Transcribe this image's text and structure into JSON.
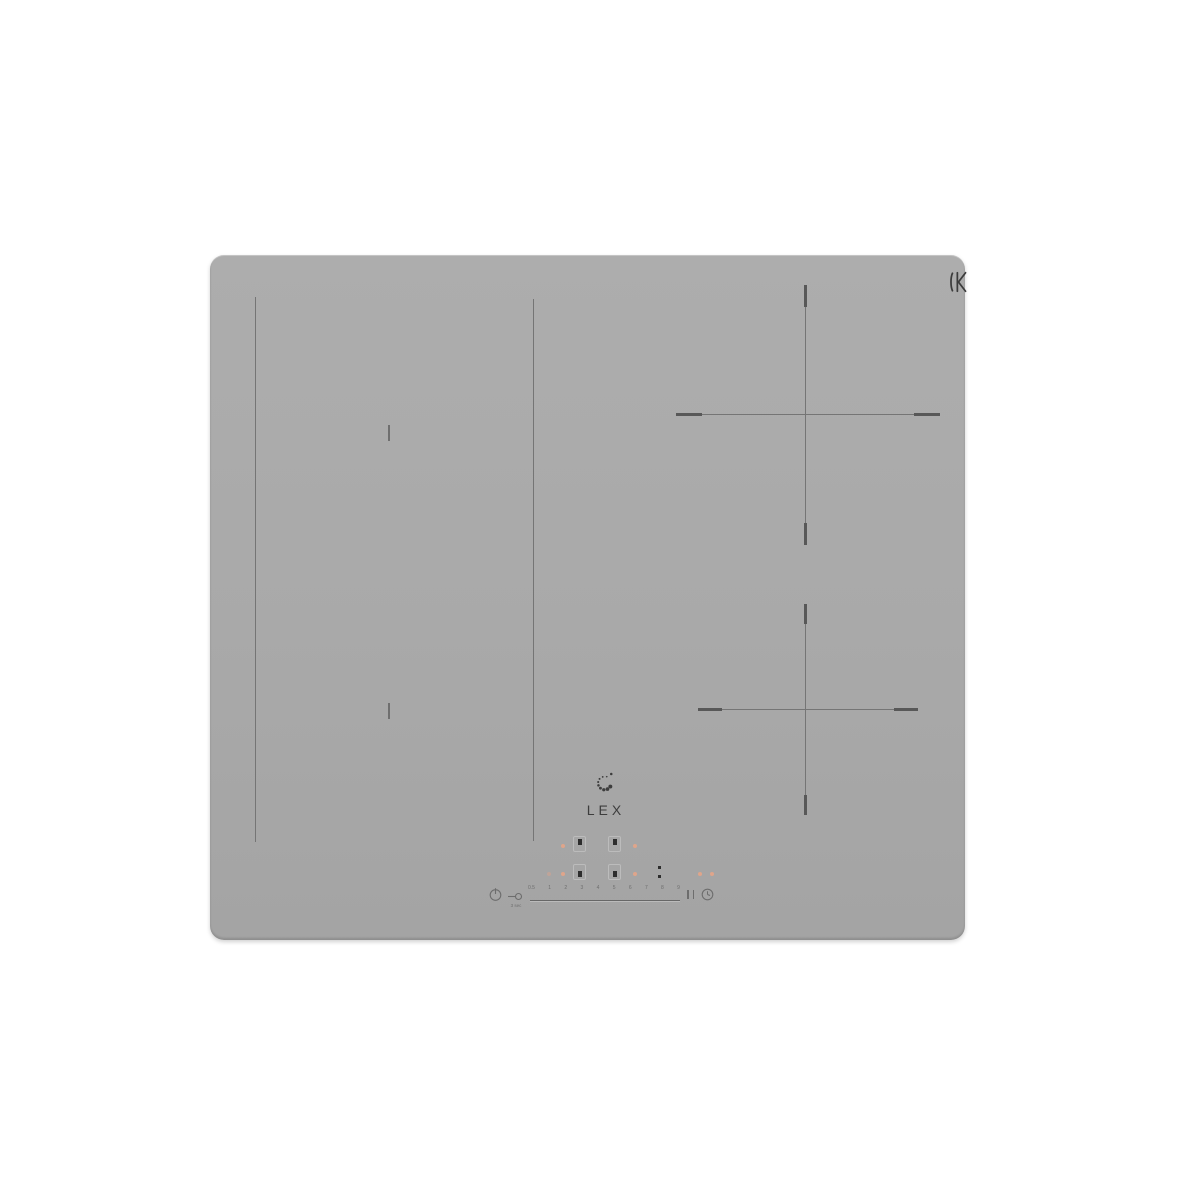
{
  "image_type": "product-photo",
  "product": {
    "brand": "LEX",
    "category": "built-in induction hob, light grey glass"
  },
  "logo": {
    "text": "LEX"
  },
  "glass_mark": {
    "text": "K"
  },
  "zones": {
    "flex_zone_left": "two vertical divider lines with center ticks",
    "right_zones": "two crosshair burner markings"
  },
  "controls": {
    "lock": {
      "caption": "3 sec"
    },
    "slider": {
      "labels": [
        "0.5",
        "1",
        "2",
        "3",
        "4",
        "5",
        "6",
        "7",
        "8",
        "9"
      ]
    }
  },
  "icons": {
    "power": "power-symbol-circle-with-bar",
    "lock": "key-horizontal",
    "pause": "double-bar",
    "timer": "clock-circle",
    "logo_mark": "dotted-swirl",
    "glass_mark": "bracket-K"
  },
  "colors": {
    "background": "#ffffff",
    "glass": "#a8a8a8",
    "zone_line": "#757575",
    "zone_line_bold": "#585858",
    "logo": "#3d3d3d",
    "heat_indicator": "#dfa58b",
    "display_mark": "#2d2d2d"
  }
}
